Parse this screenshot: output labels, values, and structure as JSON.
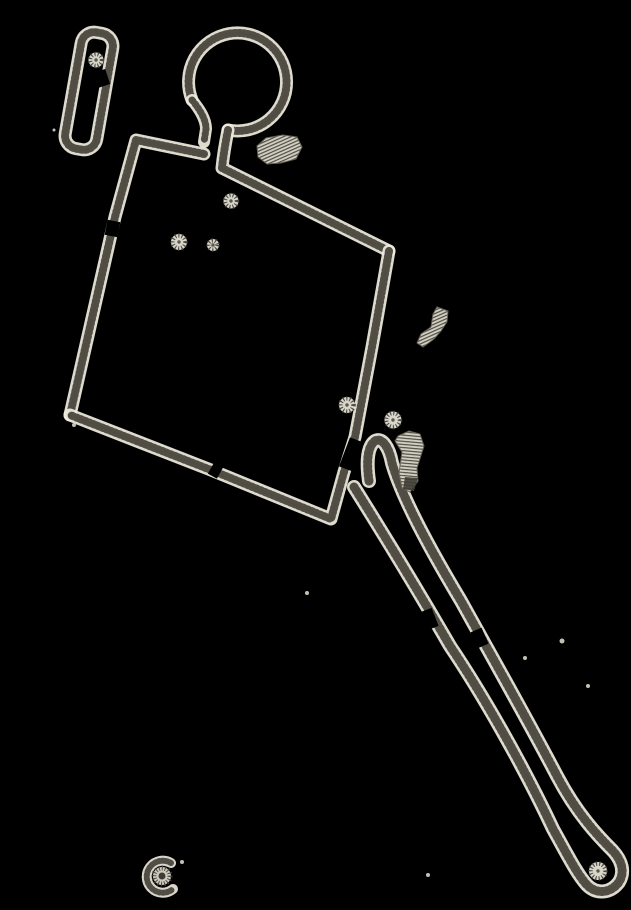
{
  "canvas": {
    "width": 631,
    "height": 910,
    "background": "#000000"
  },
  "palette": {
    "halo": "#f0ede0",
    "tick": "#45423a",
    "core": "#b7b3a4",
    "speck": "#d8d4c6",
    "blob_fill": "#d9d6c9",
    "blob_hatch": "#55524a",
    "blob_dark": "#3f3c35",
    "blob_edge": "#6b6658"
  },
  "sketch": {
    "strokes": [
      {
        "name": "pill-outline",
        "w": 8,
        "d": "M -3,-59 L 3,-59 A 13,13 0 0 1 16,-46 L 16,46 A 13,13 0 0 1 3,59 L -3,59 A 13,13 0 0 1 -16,46 L -16,-46 A 13,13 0 0 1 -3,-59 Z",
        "transform": "translate(89,91) rotate(10)"
      },
      {
        "name": "ring-outline",
        "w": 8,
        "d": "M 192,100 A 49,49 0 1 1 228,130"
      },
      {
        "name": "neck-left-line",
        "w": 7,
        "d": "M 192,100 C 201,111 206,120 206,129 L 204,142"
      },
      {
        "name": "neck-right-and-top-edge",
        "w": 8,
        "d": "M 228,130 C 225,145 223,158 222,168 L 389,251"
      },
      {
        "name": "left-edge-and-top-left-edge",
        "w": 8,
        "d": "M 204,154 L 136,140 L 115,217 L 70,415"
      },
      {
        "name": "right-edge-and-bottom-edge",
        "w": 8,
        "d": "M 389,251 L 372,347 L 355,437 L 344,472 L 331,519 L 211,470 L 70,415"
      },
      {
        "name": "handle-outline",
        "w": 9,
        "d": "M 369,481 C 366,460 368,446 375,441 C 382,437 389,447 392,463 C 402,498 431,551 461,601 C 492,657 526,717 557,776 C 577,814 598,836 613,851 C 622,861 625,872 619,882 C 611,893 597,895 587,885 C 577,874 568,856 553,829 C 522,763 481,692 450,646 C 420,594 381,530 354,487"
      }
    ],
    "gaps": [
      {
        "name": "pill-right-edge-gap",
        "x1": 99,
        "y1": 71,
        "x2": 104,
        "y2": 86,
        "w": 13
      },
      {
        "name": "left-edge-gap",
        "x1": 114,
        "y1": 221,
        "x2": 111,
        "y2": 236,
        "w": 13
      },
      {
        "name": "bottom-edge-gap",
        "x1": 211,
        "y1": 468,
        "x2": 220,
        "y2": 473,
        "w": 13
      },
      {
        "name": "right-edge-gap",
        "x1": 357,
        "y1": 440,
        "x2": 346,
        "y2": 469,
        "w": 15
      },
      {
        "name": "handle-left-line-gap",
        "x1": 426,
        "y1": 610,
        "x2": 433,
        "y2": 628,
        "w": 12
      },
      {
        "name": "handle-right-line-gap",
        "x1": 476,
        "y1": 630,
        "x2": 483,
        "y2": 646,
        "w": 12
      }
    ],
    "dots": [
      {
        "name": "starburst-dot-pill",
        "cx": 96,
        "cy": 60,
        "r": 6
      },
      {
        "name": "starburst-dot-upper",
        "cx": 231,
        "cy": 201,
        "r": 6
      },
      {
        "name": "starburst-dot-left",
        "cx": 179,
        "cy": 242,
        "r": 6.5
      },
      {
        "name": "starburst-dot-left-small",
        "cx": 213,
        "cy": 245,
        "r": 4.5
      },
      {
        "name": "starburst-dot-right-inner",
        "cx": 347,
        "cy": 405,
        "r": 6.5
      },
      {
        "name": "starburst-dot-right-outer",
        "cx": 393,
        "cy": 420,
        "r": 7
      },
      {
        "name": "starburst-dot-handle-end",
        "cx": 598,
        "cy": 871,
        "r": 7.5
      }
    ],
    "rosette": {
      "name": "rosette",
      "cx": 162,
      "cy": 876,
      "core_r": 3.5,
      "ring_r": 8,
      "arc": "M 171,863 A 16,16 0 1 0 173,889",
      "arc_w": 6
    },
    "blobs": [
      {
        "name": "hatched-patch-neck",
        "pattern": "hatchA",
        "d": "M 257,146 L 266,138 L 283,135 L 297,137 L 302,147 L 296,159 L 281,163 L 267,164 L 258,157 Z"
      },
      {
        "name": "hatched-patch-comma",
        "pattern": "hatchA",
        "d": "M 437,307 L 448,311 L 447,322 L 441,331 L 434,339 L 423,347 L 417,343 L 421,334 L 431,327 L 433,314 Z"
      },
      {
        "name": "hatched-patch-crescent",
        "pattern": "hatchC",
        "d": "M 398,436 L 409,431 L 420,434 L 424,446 L 417,468 L 418,481 L 410,492 L 402,488 L 399,473 L 402,452 L 395,441 Z"
      }
    ],
    "blob_dark_tip": {
      "name": "crescent-dark-tip",
      "d": "M 405,477 L 418,478 L 414,491 L 403,489 Z"
    },
    "specks": [
      [
        307,
        593,
        2
      ],
      [
        562,
        641,
        2.5
      ],
      [
        525,
        658,
        2
      ],
      [
        588,
        686,
        2
      ],
      [
        428,
        875,
        2
      ],
      [
        182,
        862,
        2
      ],
      [
        74,
        425,
        2
      ],
      [
        54,
        130,
        1.5
      ]
    ]
  }
}
